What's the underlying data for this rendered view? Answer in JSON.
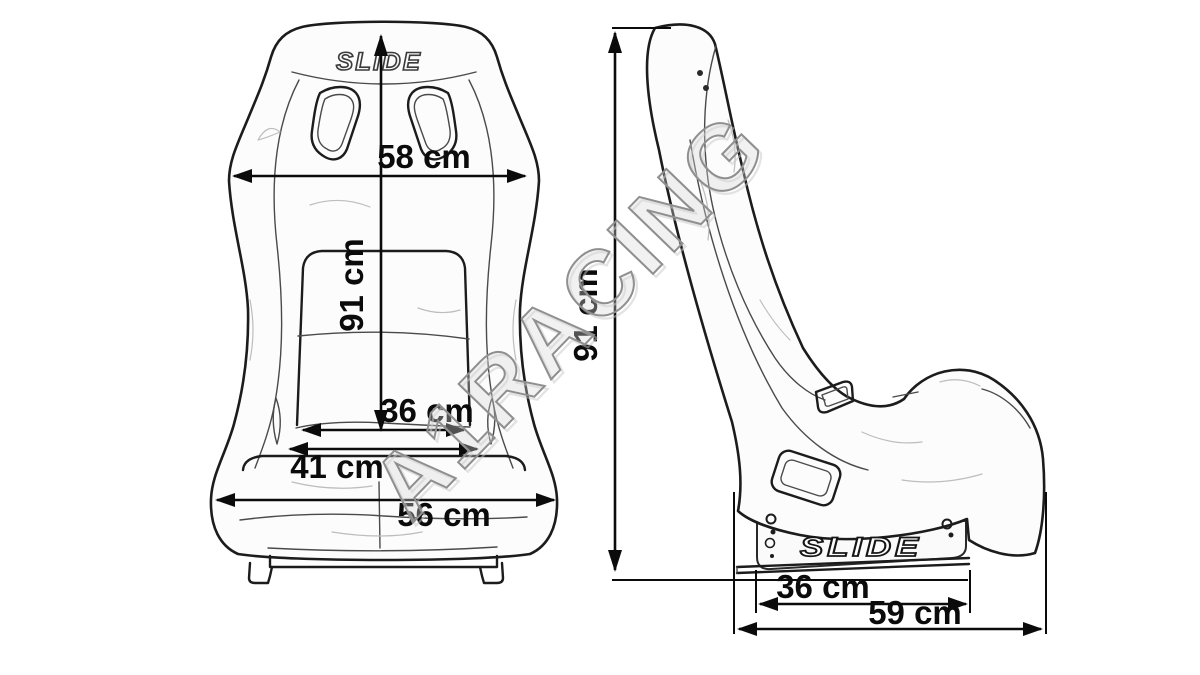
{
  "watermark": {
    "text": "A1RACING",
    "color": "#8f8f8f"
  },
  "front_view": {
    "name": "bucket seat front view",
    "brand_logo": "SLIDE",
    "dims": {
      "shoulder_width": "58 cm",
      "height": "91 cm",
      "backrest_inner_width": "36 cm",
      "seat_inner_width": "41 cm",
      "base_width": "56 cm"
    }
  },
  "side_view": {
    "name": "bucket seat side view",
    "brand_logo": "SLIDE",
    "dims": {
      "height": "91 cm",
      "mount_bracket_length": "36 cm",
      "total_depth": "59 cm"
    }
  },
  "colors": {
    "ink": "#1c1c1c",
    "dimension_ink": "#0b0b0b",
    "background": "#ffffff",
    "watermark_gray": "#8f8f8f"
  }
}
